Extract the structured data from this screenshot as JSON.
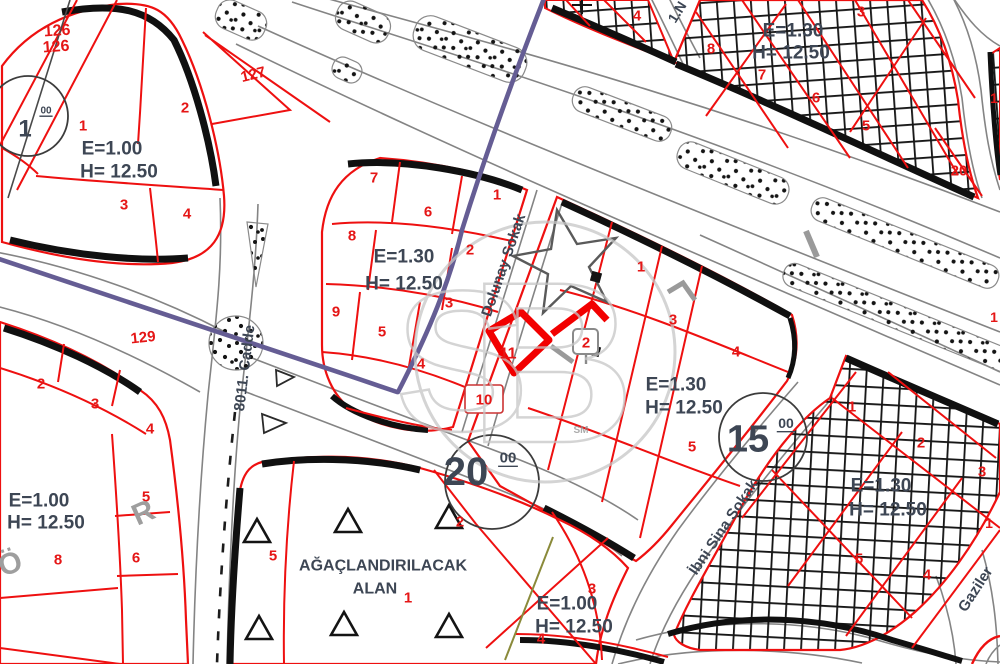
{
  "colors": {
    "red": "#e51616",
    "dark": "#3d4654",
    "gray": "#9e9e9e",
    "light": "#c6c6c6"
  },
  "map": {
    "watermark": {
      "s": "S",
      "b": "B",
      "sm": "SM"
    },
    "labels": [
      {
        "name": "parcel-126-a",
        "text": "126",
        "x": 57,
        "y": 30,
        "size": 16,
        "color": "red",
        "rot": -4
      },
      {
        "name": "parcel-126-b",
        "text": "126",
        "x": 56,
        "y": 46,
        "size": 16,
        "color": "red",
        "rot": -4
      },
      {
        "name": "block-circle-1-number",
        "text": "1",
        "x": 25,
        "y": 128,
        "size": 24,
        "color": "dark"
      },
      {
        "name": "block-circle-1-suffix",
        "text": "00",
        "x": 46,
        "y": 110,
        "size": 10,
        "color": "dark",
        "ul": true
      },
      {
        "name": "parcel-127",
        "text": "127",
        "x": 253,
        "y": 74,
        "size": 15,
        "color": "red",
        "rot": -14
      },
      {
        "name": "parcel-129",
        "text": "129",
        "x": 143,
        "y": 337,
        "size": 15,
        "color": "red",
        "rot": -6
      },
      {
        "name": "a-parcel-1",
        "text": "1",
        "x": 83,
        "y": 125,
        "size": 15,
        "color": "red"
      },
      {
        "name": "a-parcel-2",
        "text": "2",
        "x": 185,
        "y": 107,
        "size": 15,
        "color": "red"
      },
      {
        "name": "a-parcel-3",
        "text": "3",
        "x": 124,
        "y": 204,
        "size": 15,
        "color": "red"
      },
      {
        "name": "a-parcel-4",
        "text": "4",
        "x": 187,
        "y": 213,
        "size": 15,
        "color": "red"
      },
      {
        "name": "a-emsal",
        "text": "E=1.00",
        "x": 112,
        "y": 148,
        "size": 19,
        "color": "dark"
      },
      {
        "name": "a-hmax",
        "text": "H= 12.50",
        "x": 119,
        "y": 171,
        "size": 19,
        "color": "dark"
      },
      {
        "name": "g-parcel-2",
        "text": "2",
        "x": 41,
        "y": 383,
        "size": 15,
        "color": "red"
      },
      {
        "name": "g-parcel-3",
        "text": "3",
        "x": 95,
        "y": 403,
        "size": 15,
        "color": "red"
      },
      {
        "name": "g-parcel-4",
        "text": "4",
        "x": 150,
        "y": 428,
        "size": 15,
        "color": "red"
      },
      {
        "name": "g-parcel-5",
        "text": "5",
        "x": 146,
        "y": 496,
        "size": 15,
        "color": "red"
      },
      {
        "name": "g-parcel-6",
        "text": "6",
        "x": 136,
        "y": 557,
        "size": 15,
        "color": "red"
      },
      {
        "name": "g-parcel-8",
        "text": "8",
        "x": 58,
        "y": 559,
        "size": 15,
        "color": "red"
      },
      {
        "name": "g-emsal",
        "text": "E=1.00",
        "x": 39,
        "y": 500,
        "size": 19,
        "color": "dark"
      },
      {
        "name": "g-hmax",
        "text": "H= 12.50",
        "x": 46,
        "y": 522,
        "size": 19,
        "color": "dark"
      },
      {
        "name": "street-8011-cadde",
        "text": "8011. Cadde",
        "x": 244,
        "y": 368,
        "size": 15,
        "color": "dark",
        "rot": -83
      },
      {
        "name": "road-letter-r",
        "text": "R",
        "x": 143,
        "y": 512,
        "size": 30,
        "color": "gray",
        "rot": -24
      },
      {
        "name": "road-letter-o",
        "text": "Ö",
        "x": 10,
        "y": 563,
        "size": 30,
        "color": "gray",
        "rot": -18
      },
      {
        "name": "b-parcel-7",
        "text": "7",
        "x": 374,
        "y": 177,
        "size": 15,
        "color": "red"
      },
      {
        "name": "b-parcel-6",
        "text": "6",
        "x": 428,
        "y": 211,
        "size": 15,
        "color": "red"
      },
      {
        "name": "b-parcel-1",
        "text": "1",
        "x": 497,
        "y": 194,
        "size": 15,
        "color": "red"
      },
      {
        "name": "b-parcel-8",
        "text": "8",
        "x": 352,
        "y": 235,
        "size": 15,
        "color": "red"
      },
      {
        "name": "b-parcel-2",
        "text": "2",
        "x": 470,
        "y": 249,
        "size": 15,
        "color": "red"
      },
      {
        "name": "b-parcel-9",
        "text": "9",
        "x": 336,
        "y": 311,
        "size": 15,
        "color": "red"
      },
      {
        "name": "b-parcel-5",
        "text": "5",
        "x": 382,
        "y": 331,
        "size": 15,
        "color": "red"
      },
      {
        "name": "b-parcel-3",
        "text": "3",
        "x": 449,
        "y": 302,
        "size": 15,
        "color": "red"
      },
      {
        "name": "b-parcel-4",
        "text": "4",
        "x": 421,
        "y": 363,
        "size": 15,
        "color": "red"
      },
      {
        "name": "b-emsal",
        "text": "E=1.30",
        "x": 404,
        "y": 256,
        "size": 19,
        "color": "dark"
      },
      {
        "name": "b-hmax",
        "text": "H= 12.50",
        "x": 404,
        "y": 283,
        "size": 19,
        "color": "dark"
      },
      {
        "name": "street-dolunay-sokak",
        "text": "Dolunay Sokak",
        "x": 503,
        "y": 265,
        "size": 15,
        "color": "dark",
        "rot": -71
      },
      {
        "name": "c-parcel-1",
        "text": "1",
        "x": 641,
        "y": 266,
        "size": 15,
        "color": "red"
      },
      {
        "name": "c-parcel-3",
        "text": "3",
        "x": 673,
        "y": 319,
        "size": 15,
        "color": "red"
      },
      {
        "name": "c-parcel-4",
        "text": "4",
        "x": 736,
        "y": 351,
        "size": 15,
        "color": "red"
      },
      {
        "name": "c-parcel-5",
        "text": "5",
        "x": 692,
        "y": 446,
        "size": 15,
        "color": "red"
      },
      {
        "name": "c-parcel-11",
        "text": "11",
        "x": 508,
        "y": 353,
        "size": 16,
        "color": "red"
      },
      {
        "name": "c-parcel-10",
        "text": "10",
        "x": 484,
        "y": 399,
        "size": 15,
        "color": "red"
      },
      {
        "name": "c-door-plate-2",
        "text": "2",
        "x": 586,
        "y": 342,
        "size": 15,
        "color": "red"
      },
      {
        "name": "c-emsal",
        "text": "E=1.30",
        "x": 676,
        "y": 384,
        "size": 19,
        "color": "dark"
      },
      {
        "name": "c-hmax",
        "text": "H= 12.50",
        "x": 684,
        "y": 407,
        "size": 19,
        "color": "dark"
      },
      {
        "name": "street-ibni-sina-sokak",
        "text": "İbni Sina Sokak",
        "x": 723,
        "y": 527,
        "size": 15,
        "color": "dark",
        "rot": -56
      },
      {
        "name": "block-circle-20-number",
        "text": "20",
        "x": 466,
        "y": 471,
        "size": 40,
        "color": "dark"
      },
      {
        "name": "block-circle-20-suffix",
        "text": "00",
        "x": 508,
        "y": 457,
        "size": 15,
        "color": "dark",
        "ul": true
      },
      {
        "name": "block-circle-15-number",
        "text": "15",
        "x": 748,
        "y": 438,
        "size": 38,
        "color": "dark"
      },
      {
        "name": "block-circle-15-suffix",
        "text": "00",
        "x": 786,
        "y": 423,
        "size": 14,
        "color": "dark",
        "ul": true
      },
      {
        "name": "d-area-title-line1",
        "text": "AĞAÇLANDIRILACAK",
        "x": 383,
        "y": 565,
        "size": 16,
        "color": "dark"
      },
      {
        "name": "d-area-title-line2",
        "text": "ALAN",
        "x": 375,
        "y": 588,
        "size": 16,
        "color": "dark"
      },
      {
        "name": "d-parcel-1",
        "text": "1",
        "x": 408,
        "y": 597,
        "size": 15,
        "color": "red"
      },
      {
        "name": "d-parcel-2",
        "text": "2",
        "x": 460,
        "y": 521,
        "size": 15,
        "color": "red"
      },
      {
        "name": "d-parcel-5",
        "text": "5",
        "x": 273,
        "y": 555,
        "size": 15,
        "color": "red"
      },
      {
        "name": "d-parcel-3",
        "text": "3",
        "x": 592,
        "y": 588,
        "size": 15,
        "color": "red"
      },
      {
        "name": "d-parcel-4",
        "text": "4",
        "x": 541,
        "y": 638,
        "size": 15,
        "color": "red"
      },
      {
        "name": "d-emsal",
        "text": "E=1.00",
        "x": 567,
        "y": 603,
        "size": 19,
        "color": "dark"
      },
      {
        "name": "d-hmax",
        "text": "H= 12.50",
        "x": 574,
        "y": 626,
        "size": 19,
        "color": "dark"
      },
      {
        "name": "h-parcel-8",
        "text": "8",
        "x": 711,
        "y": 48,
        "size": 15,
        "color": "red"
      },
      {
        "name": "h-parcel-7",
        "text": "7",
        "x": 762,
        "y": 74,
        "size": 15,
        "color": "red"
      },
      {
        "name": "h-parcel-6",
        "text": "6",
        "x": 816,
        "y": 97,
        "size": 15,
        "color": "red"
      },
      {
        "name": "h-parcel-5",
        "text": "5",
        "x": 866,
        "y": 125,
        "size": 15,
        "color": "red"
      },
      {
        "name": "h-parcel-3",
        "text": "3",
        "x": 861,
        "y": 11,
        "size": 15,
        "color": "red"
      },
      {
        "name": "h-parcel-4",
        "text": "4",
        "x": 637,
        "y": 15,
        "size": 15,
        "color": "red"
      },
      {
        "name": "h-emsal",
        "text": "E=1.30",
        "x": 793,
        "y": 30,
        "size": 19,
        "color": "dark"
      },
      {
        "name": "h-hmax",
        "text": "H= 12.50",
        "x": 791,
        "y": 52,
        "size": 19,
        "color": "dark"
      },
      {
        "name": "h-parcel-20",
        "text": "20",
        "x": 959,
        "y": 170,
        "size": 15,
        "color": "red"
      },
      {
        "name": "h-parcel-1",
        "text": "1",
        "x": 994,
        "y": 98,
        "size": 14,
        "color": "red"
      },
      {
        "name": "street-1n",
        "text": "1.N",
        "x": 677,
        "y": 12,
        "size": 14,
        "color": "dark",
        "rot": -58
      },
      {
        "name": "roadside-parcel-1",
        "text": "1",
        "x": 994,
        "y": 317,
        "size": 14,
        "color": "red"
      },
      {
        "name": "i-parcel-1",
        "text": "1",
        "x": 852,
        "y": 406,
        "size": 15,
        "color": "red"
      },
      {
        "name": "i-parcel-2",
        "text": "2",
        "x": 921,
        "y": 442,
        "size": 15,
        "color": "red"
      },
      {
        "name": "i-parcel-3",
        "text": "3",
        "x": 982,
        "y": 471,
        "size": 15,
        "color": "red"
      },
      {
        "name": "i-parcel-5",
        "text": "5",
        "x": 859,
        "y": 558,
        "size": 15,
        "color": "red"
      },
      {
        "name": "i-parcel-4",
        "text": "4",
        "x": 927,
        "y": 574,
        "size": 15,
        "color": "red"
      },
      {
        "name": "i-right-parcel-1",
        "text": "1",
        "x": 989,
        "y": 523,
        "size": 14,
        "color": "red"
      },
      {
        "name": "i-emsal",
        "text": "E=1.30",
        "x": 881,
        "y": 485,
        "size": 19,
        "color": "dark"
      },
      {
        "name": "i-hmax",
        "text": "H= 12.50",
        "x": 888,
        "y": 509,
        "size": 19,
        "color": "dark"
      },
      {
        "name": "street-gaziler",
        "text": "Gaziler",
        "x": 975,
        "y": 589,
        "size": 15,
        "color": "dark",
        "rot": -57
      }
    ]
  }
}
